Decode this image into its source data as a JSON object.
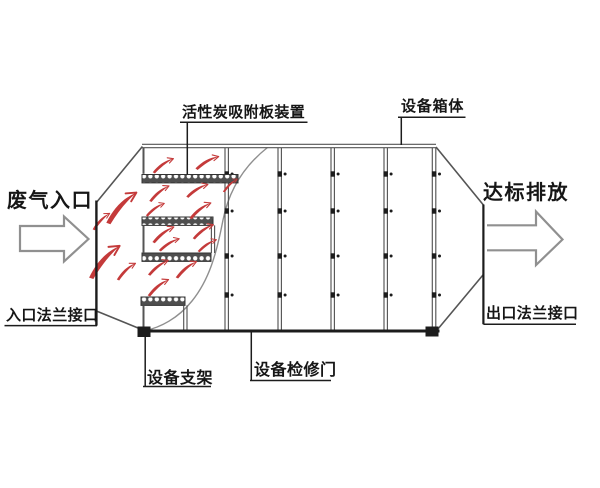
{
  "colors": {
    "line": "#555555",
    "dark": "#1c1c1c",
    "curve": "#8f8f8f",
    "red": "#c43a3a",
    "bar_fill": "#4f4f4f",
    "bead": "#ffffff",
    "arrow_outline": "#909090",
    "background": "#ffffff",
    "text": "#161616"
  },
  "labels": {
    "carbon_plate": "活性炭吸附板装置",
    "equipment_box": "设备箱体",
    "waste_gas_inlet": "废气入口",
    "compliant_discharge": "达标排放",
    "inlet_flange": "入口法兰接口",
    "outlet_flange": "出口法兰接口",
    "equipment_support": "设备支架",
    "access_door": "设备检修门"
  },
  "icons": {
    "inlet_arrow": "flow-arrow-right",
    "outlet_arrow": "flow-arrow-right",
    "carbon_plate_bar": "beaded-adsorption-plate",
    "gas_flow_mark": "red-flow-swoosh"
  }
}
